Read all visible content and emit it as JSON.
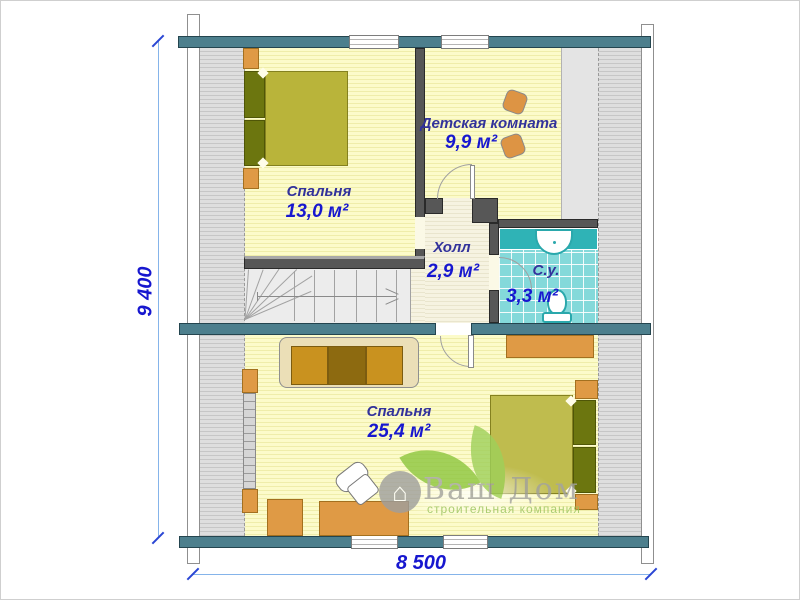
{
  "plan": {
    "dimensions": {
      "height_label": "9 400",
      "width_label": "8 500"
    },
    "rooms": [
      {
        "id": "bedroom-upper",
        "name": "Спальня",
        "area": "13,0 м²"
      },
      {
        "id": "kids-room",
        "name": "Детская комната",
        "area": "9,9 м²"
      },
      {
        "id": "hall",
        "name": "Холл",
        "area": "2,9 м²"
      },
      {
        "id": "bathroom",
        "name": "С.у.",
        "area": "3,3 м²"
      },
      {
        "id": "bedroom-lower",
        "name": "Спальня",
        "area": "25,4 м²"
      }
    ]
  },
  "logo": {
    "title": "Ваш Дом",
    "subtitle": "строительная компания",
    "house_glyph": "⌂"
  },
  "colors": {
    "wall_teal": "#4d7f8d",
    "interior_wall": "#575757",
    "floor_yellow": "#fbf9c6",
    "hall_floor": "#f5f2df",
    "tile_teal": "#84d9da",
    "furniture_orange": "#df9a45",
    "bed_olive": "#b9b43a",
    "dim_blue": "#1717cf",
    "room_name_navy": "#32329b",
    "logo_green": "#8cc63e",
    "logo_grey": "#a3a3a3"
  }
}
